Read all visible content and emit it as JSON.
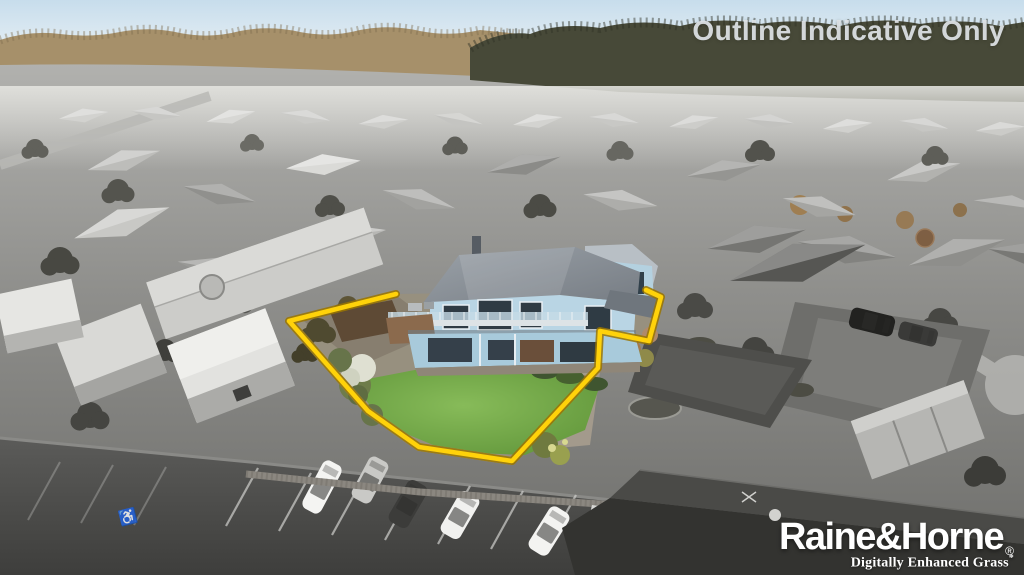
{
  "overlay": {
    "outline_note": "Outline Indicative Only"
  },
  "branding": {
    "logo": "Raine&Horne",
    "registered_mark": "®",
    "tagline": "Digitally Enhanced Grass",
    "tagline_mark": "*"
  },
  "parking": {
    "disabled_symbol": "♿"
  },
  "outline": {
    "points_str": "396,294 289,321 368,411 419,447 512,461 598,368 600,331 649,341 661,297 646,290",
    "color": "#FFD20A",
    "edge_color": "#9A7500"
  },
  "colors": {
    "sky_top": "#C7DDEC",
    "sky_horizon": "#EAF1F5",
    "treeline_left": "#A6906A",
    "treeline_right": "#474938",
    "house_blue": "#B9D5E4",
    "house_blue_lower": "#A8CADB",
    "roof_gray": "#8A9097",
    "lawn_green": "#6FA843",
    "asphalt": "#4E4E4C",
    "note_text": "#DFE2E4",
    "logo_text": "#FFFFFF"
  }
}
